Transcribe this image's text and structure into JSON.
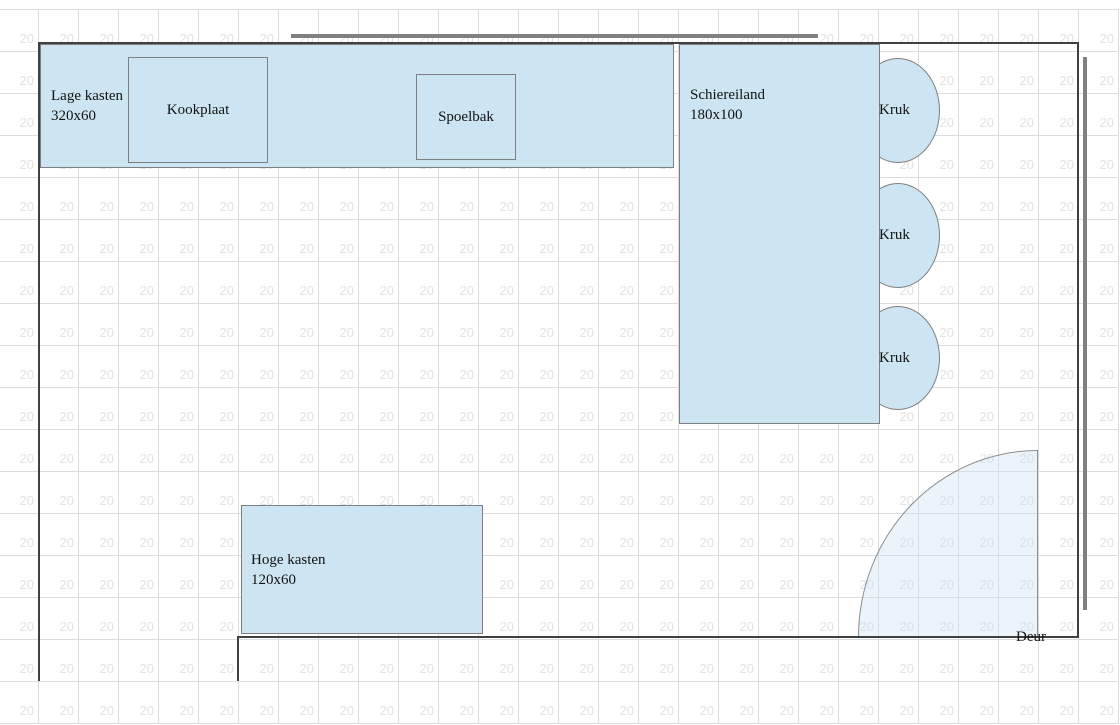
{
  "plan": {
    "grid": {
      "label": "20",
      "cols": 28,
      "rows": 17,
      "cell_width": 40,
      "cell_height": 42,
      "offset_x": -2,
      "offset_y": 9
    },
    "colors": {
      "furniture_fill": "#cde4f2",
      "furniture_border": "#7f7f7f",
      "wall": "#404040",
      "wall_marker": "#808080",
      "grid_line": "#dcdcdc",
      "grid_label": "#e2e2e2",
      "door_fill": "rgba(198,224,240,0.35)",
      "text": "#121212"
    },
    "cabinets": {
      "lage_kasten": {
        "name_line": "Lage kasten",
        "size_line": "320x60"
      },
      "kookplaat": {
        "label": "Kookplaat"
      },
      "spoelbak": {
        "label": "Spoelbak"
      },
      "schiereiland": {
        "name_line": "Schiereiland",
        "size_line": "180x100"
      },
      "hoge_kasten": {
        "name_line": "Hoge kasten",
        "size_line": "120x60"
      }
    },
    "stools": [
      {
        "label": "Kruk"
      },
      {
        "label": "Kruk"
      },
      {
        "label": "Kruk"
      }
    ],
    "door": {
      "label": "Deur"
    }
  }
}
